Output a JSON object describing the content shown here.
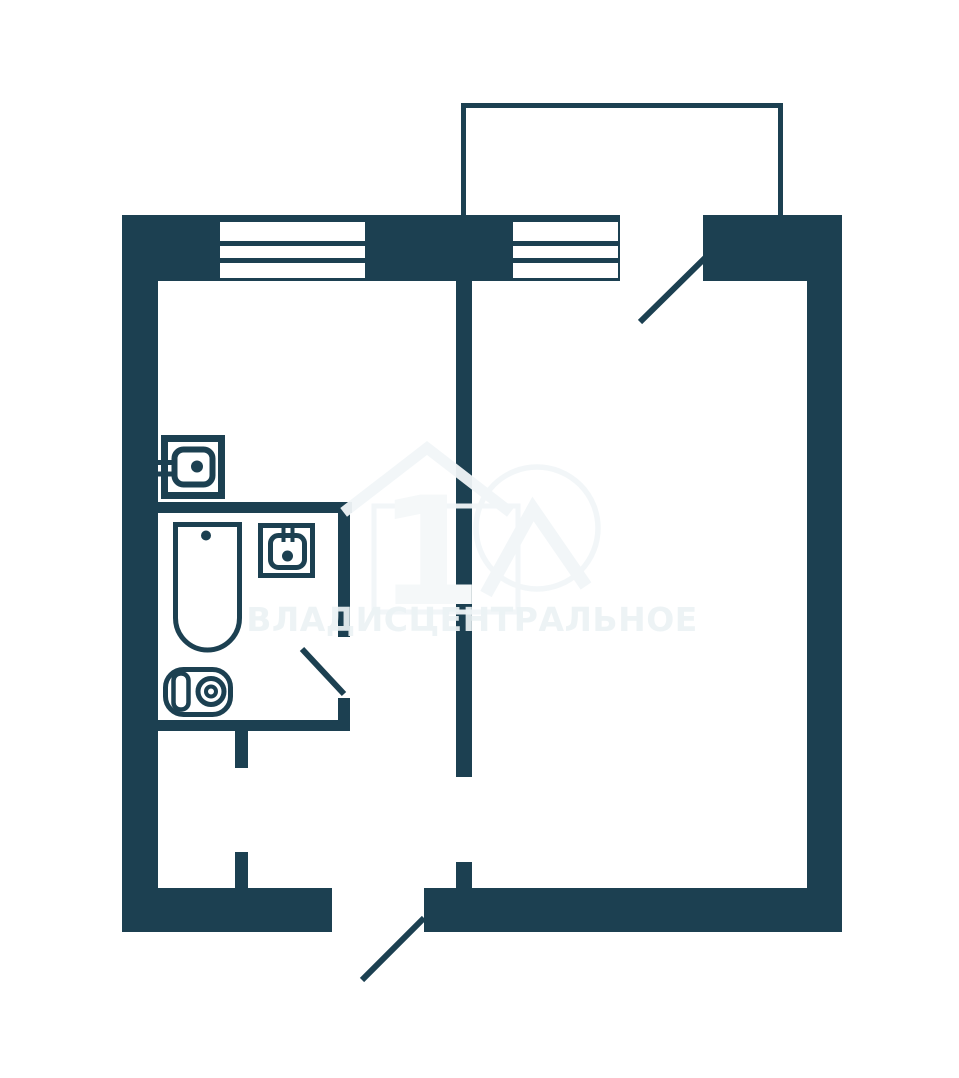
{
  "colors": {
    "wall": "#1c4051",
    "paper": "#ffffff",
    "wm_fill": "rgba(255,255,255,0.55)",
    "wm_stroke": "rgba(241,246,248,0.95)",
    "wm_digit": "#f5f8f9",
    "wm_text": "rgba(236,242,244,0.92)"
  },
  "watermark": {
    "brand_text": "ВЛАДИСЦЕНТРАЛЬНОЕ",
    "logo_digit": "1"
  },
  "plan": {
    "type": "one-room apartment floor plan",
    "icons": [
      {
        "name": "balcony-outline-icon"
      },
      {
        "name": "window-icon",
        "count": 2
      },
      {
        "name": "door-swing-icon",
        "count": 3
      },
      {
        "name": "kitchen-sink-icon"
      },
      {
        "name": "bathtub-icon"
      },
      {
        "name": "washbasin-icon"
      },
      {
        "name": "toilet-icon"
      },
      {
        "name": "house-logo-icon"
      }
    ]
  }
}
